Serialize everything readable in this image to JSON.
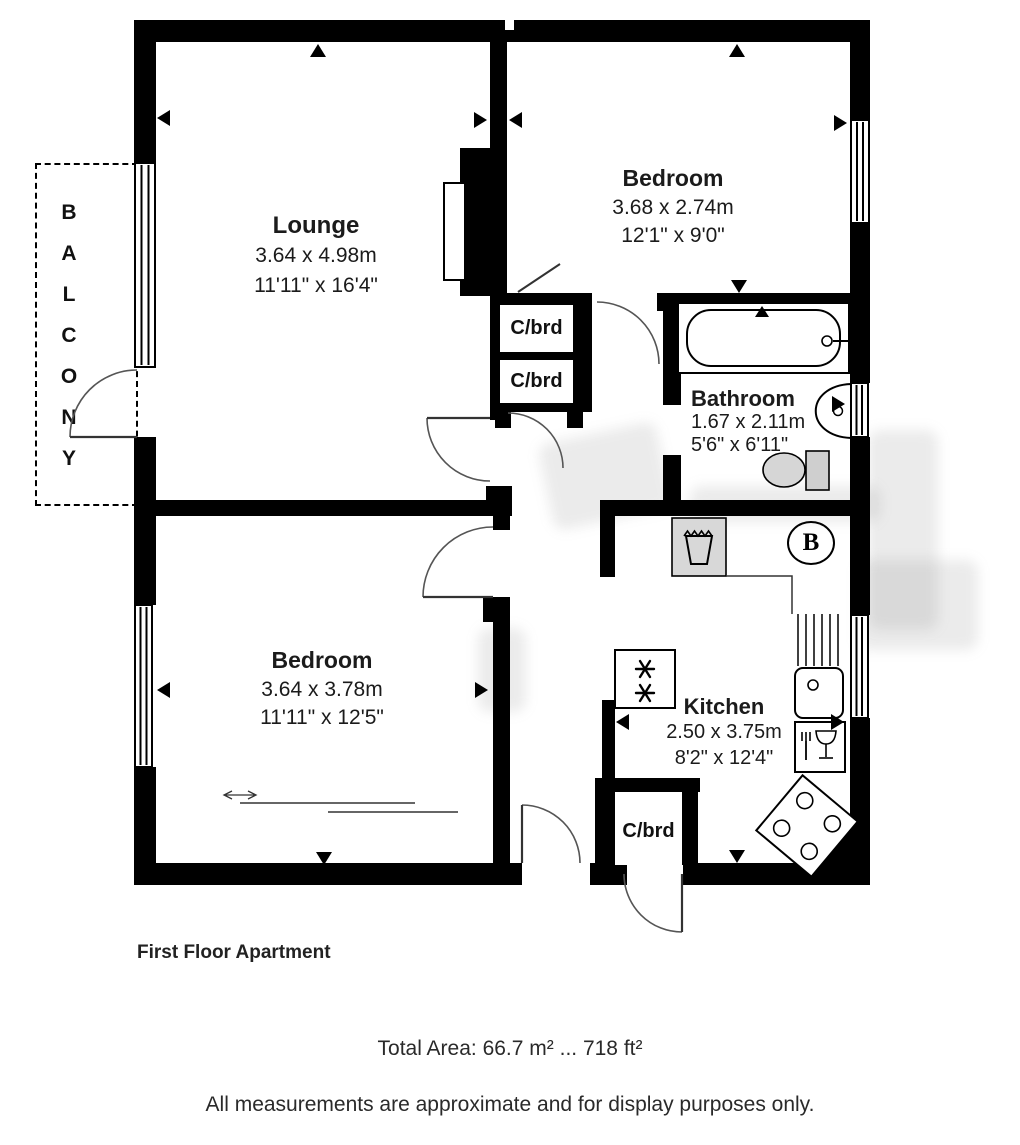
{
  "floorplan": {
    "rooms": {
      "lounge": {
        "name": "Lounge",
        "metric": "3.64 x 4.98m",
        "imperial": "11'11\" x 16'4\""
      },
      "bedroom_top": {
        "name": "Bedroom",
        "metric": "3.68 x 2.74m",
        "imperial": "12'1\" x 9'0\""
      },
      "bathroom": {
        "name": "Bathroom",
        "metric": "1.67 x 2.11m",
        "imperial": "5'6\" x 6'11\""
      },
      "bedroom_bottom": {
        "name": "Bedroom",
        "metric": "3.64 x 3.78m",
        "imperial": "11'11\" x 12'5\""
      },
      "kitchen": {
        "name": "Kitchen",
        "metric": "2.50 x 3.75m",
        "imperial": "8'2\" x 12'4\""
      },
      "balcony": {
        "name": "B A L C O N Y"
      }
    },
    "cupboards": {
      "hall_upper": "C/brd",
      "hall_lower": "C/brd",
      "entrance": "C/brd"
    },
    "boiler_label": "B",
    "footer": {
      "title": "First Floor Apartment",
      "total_area": "Total Area: 66.7 m² ... 718 ft²",
      "disclaimer": "All measurements are approximate and for display purposes only."
    },
    "colors": {
      "wall": "#000000",
      "appliance_grey": "#d8d8d8",
      "door_line": "#555555"
    }
  }
}
